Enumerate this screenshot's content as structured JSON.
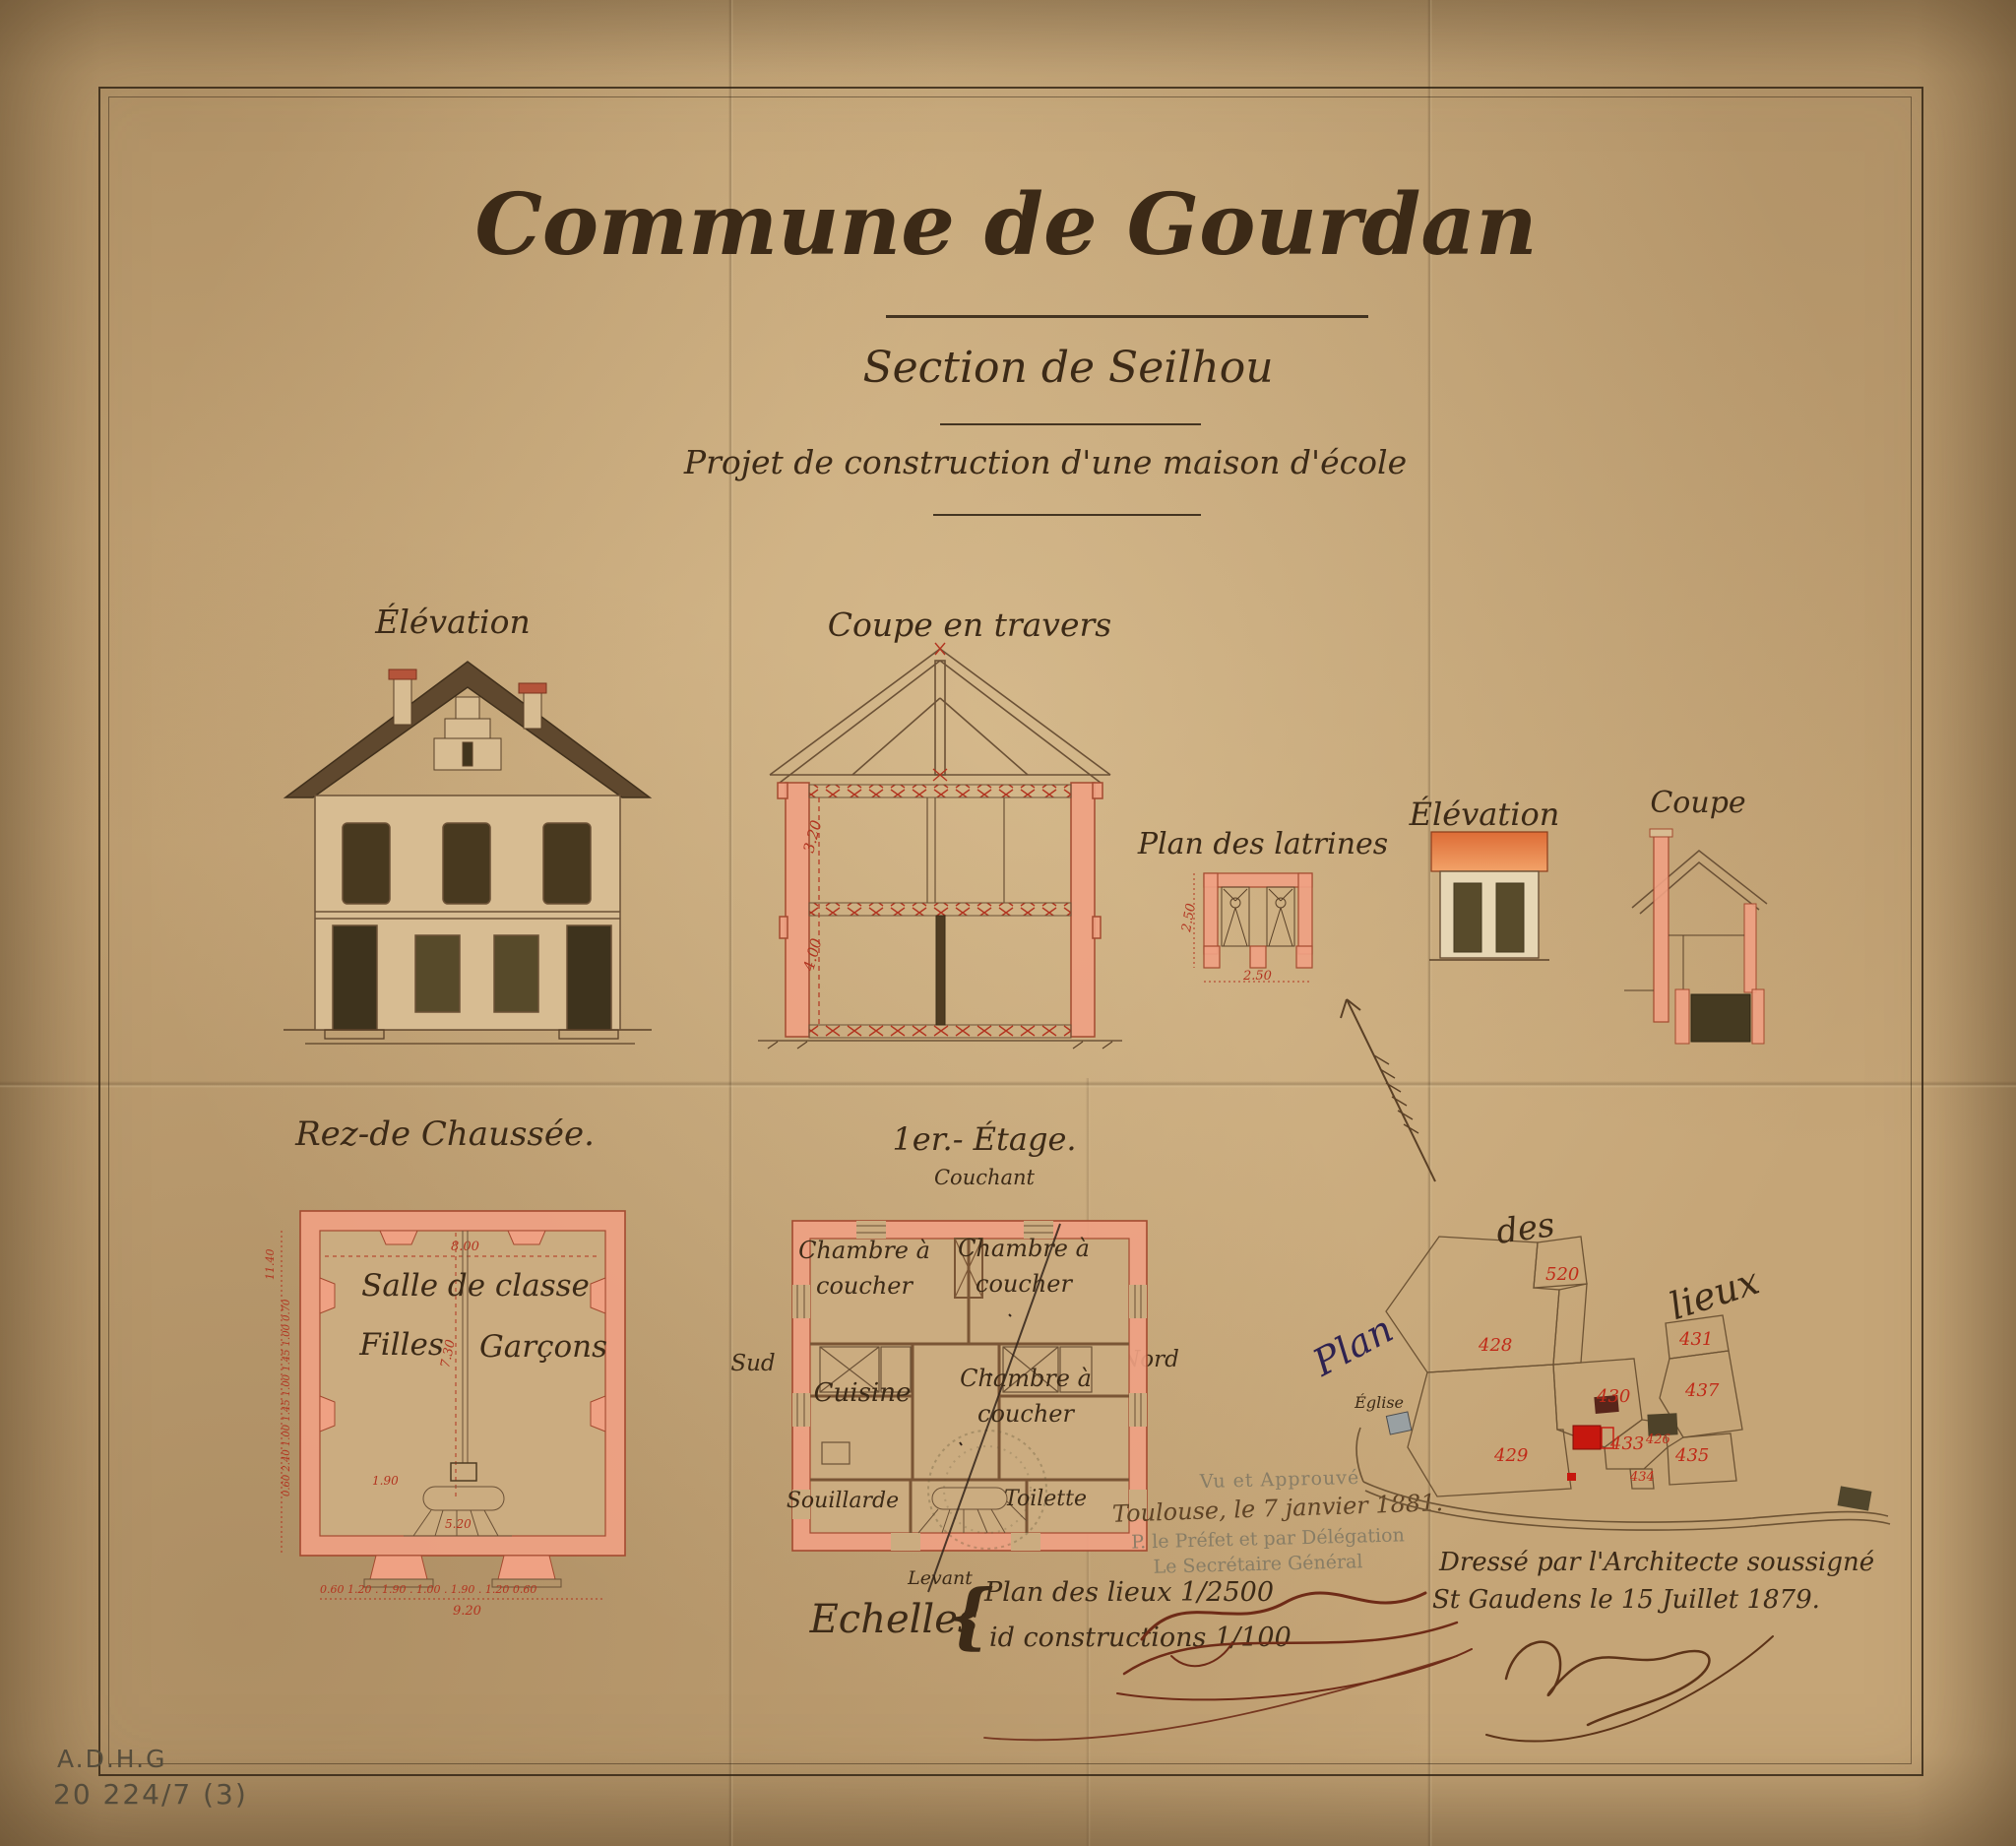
{
  "page": {
    "title": "Commune de Gourdan",
    "section": "Section de Seilhou",
    "project": "Projet de construction d'une maison d'école"
  },
  "labels": {
    "elevation": "Élévation",
    "section_cut": "Coupe en travers",
    "latrine_plan": "Plan des latrines",
    "latrine_elevation": "Élévation",
    "latrine_section": "Coupe",
    "ground_floor": "Rez-de Chaussée.",
    "first_floor": "1er.- Étage.",
    "orientation_top": "Couchant",
    "orientation_left": "Sud",
    "orientation_right": "Nord",
    "orientation_bottom": "Levant"
  },
  "ground_floor": {
    "room_main": "Salle de classe",
    "room_left": "Filles",
    "room_right": "Garçons",
    "dim_top": "8.00",
    "dim_mid_vertical": "7.30",
    "dim_stair_1": "1.90",
    "dim_stair_2": "5.20",
    "dim_left_total": "11.40",
    "dim_left_chain": "0.60  2.40  1.00  1.45  1.00  1.45  1.00  0.70",
    "dim_bottom_chain": "0.60   1.20 .   1.90   . 1.00 .   1.90 .   1.20   0.60",
    "dim_bottom_total": "9.20"
  },
  "first_floor": {
    "rooms": [
      "Chambre à coucher",
      "Chambre à coucher",
      "Cuisine",
      "Chambre à coucher",
      "Souillarde",
      "Toilette"
    ]
  },
  "section_dims": {
    "upper": "3.20",
    "lower": "4.00"
  },
  "latrines": {
    "dim_vertical": "2.50",
    "dim_horizontal": "2.50"
  },
  "site_plan": {
    "word_plan": "Plan",
    "word_des": "des",
    "word_lieux": "lieux",
    "church": "Église",
    "parcels": [
      {
        "n": "520"
      },
      {
        "n": "428"
      },
      {
        "n": "431"
      },
      {
        "n": "430"
      },
      {
        "n": "437"
      },
      {
        "n": "433"
      },
      {
        "n": "426"
      },
      {
        "n": "429"
      },
      {
        "n": "435"
      },
      {
        "n": "434"
      }
    ]
  },
  "scales": {
    "label": "Echelles",
    "brace": "{",
    "line1": "Plan des lieux 1/2500",
    "line2": "id constructions 1/100"
  },
  "approval_stamp": {
    "line1": "Vu et Approuvé",
    "line2": "Toulouse, le 7 janvier 1881.",
    "line3": "P. le Préfet et par Délégation",
    "line4": "Le Secrétaire Général"
  },
  "architect": {
    "line1": "Dressé par l'Architecte soussigné",
    "line2": "St Gaudens le 15 Juillet 1879."
  },
  "archive": {
    "line1": "A.D.H.G",
    "line2": "20 224/7 (3)"
  },
  "colors": {
    "paper": "#c5a577",
    "ink": "#3c2a17",
    "red_ink": "#b23420",
    "wall_wash": "#efa183",
    "roof": "#5f482e"
  }
}
